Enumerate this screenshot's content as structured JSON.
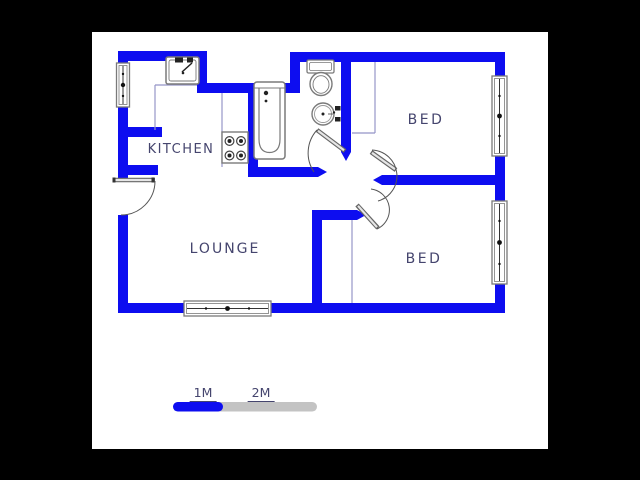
{
  "colors": {
    "background": "#000000",
    "paper": "#ffffff",
    "wall": "#0d0df0",
    "room_outline": "#9595c8",
    "fixture_outline": "#7a7a7a",
    "door": "#555555",
    "label_text": "#45456e",
    "scale_blue": "#0d0df0",
    "scale_gray": "#c3c3c3"
  },
  "rooms": {
    "kitchen": {
      "label": "KITCHEN"
    },
    "bed_top": {
      "label": "BED"
    },
    "bed_bottom": {
      "label": "BED"
    },
    "lounge": {
      "label": "LOUNGE"
    }
  },
  "fixtures": [
    "kitchen-sink",
    "stove",
    "bathtub",
    "toilet",
    "basin"
  ],
  "scale_bar": {
    "label_1m": "1M",
    "label_2m": "2M"
  }
}
